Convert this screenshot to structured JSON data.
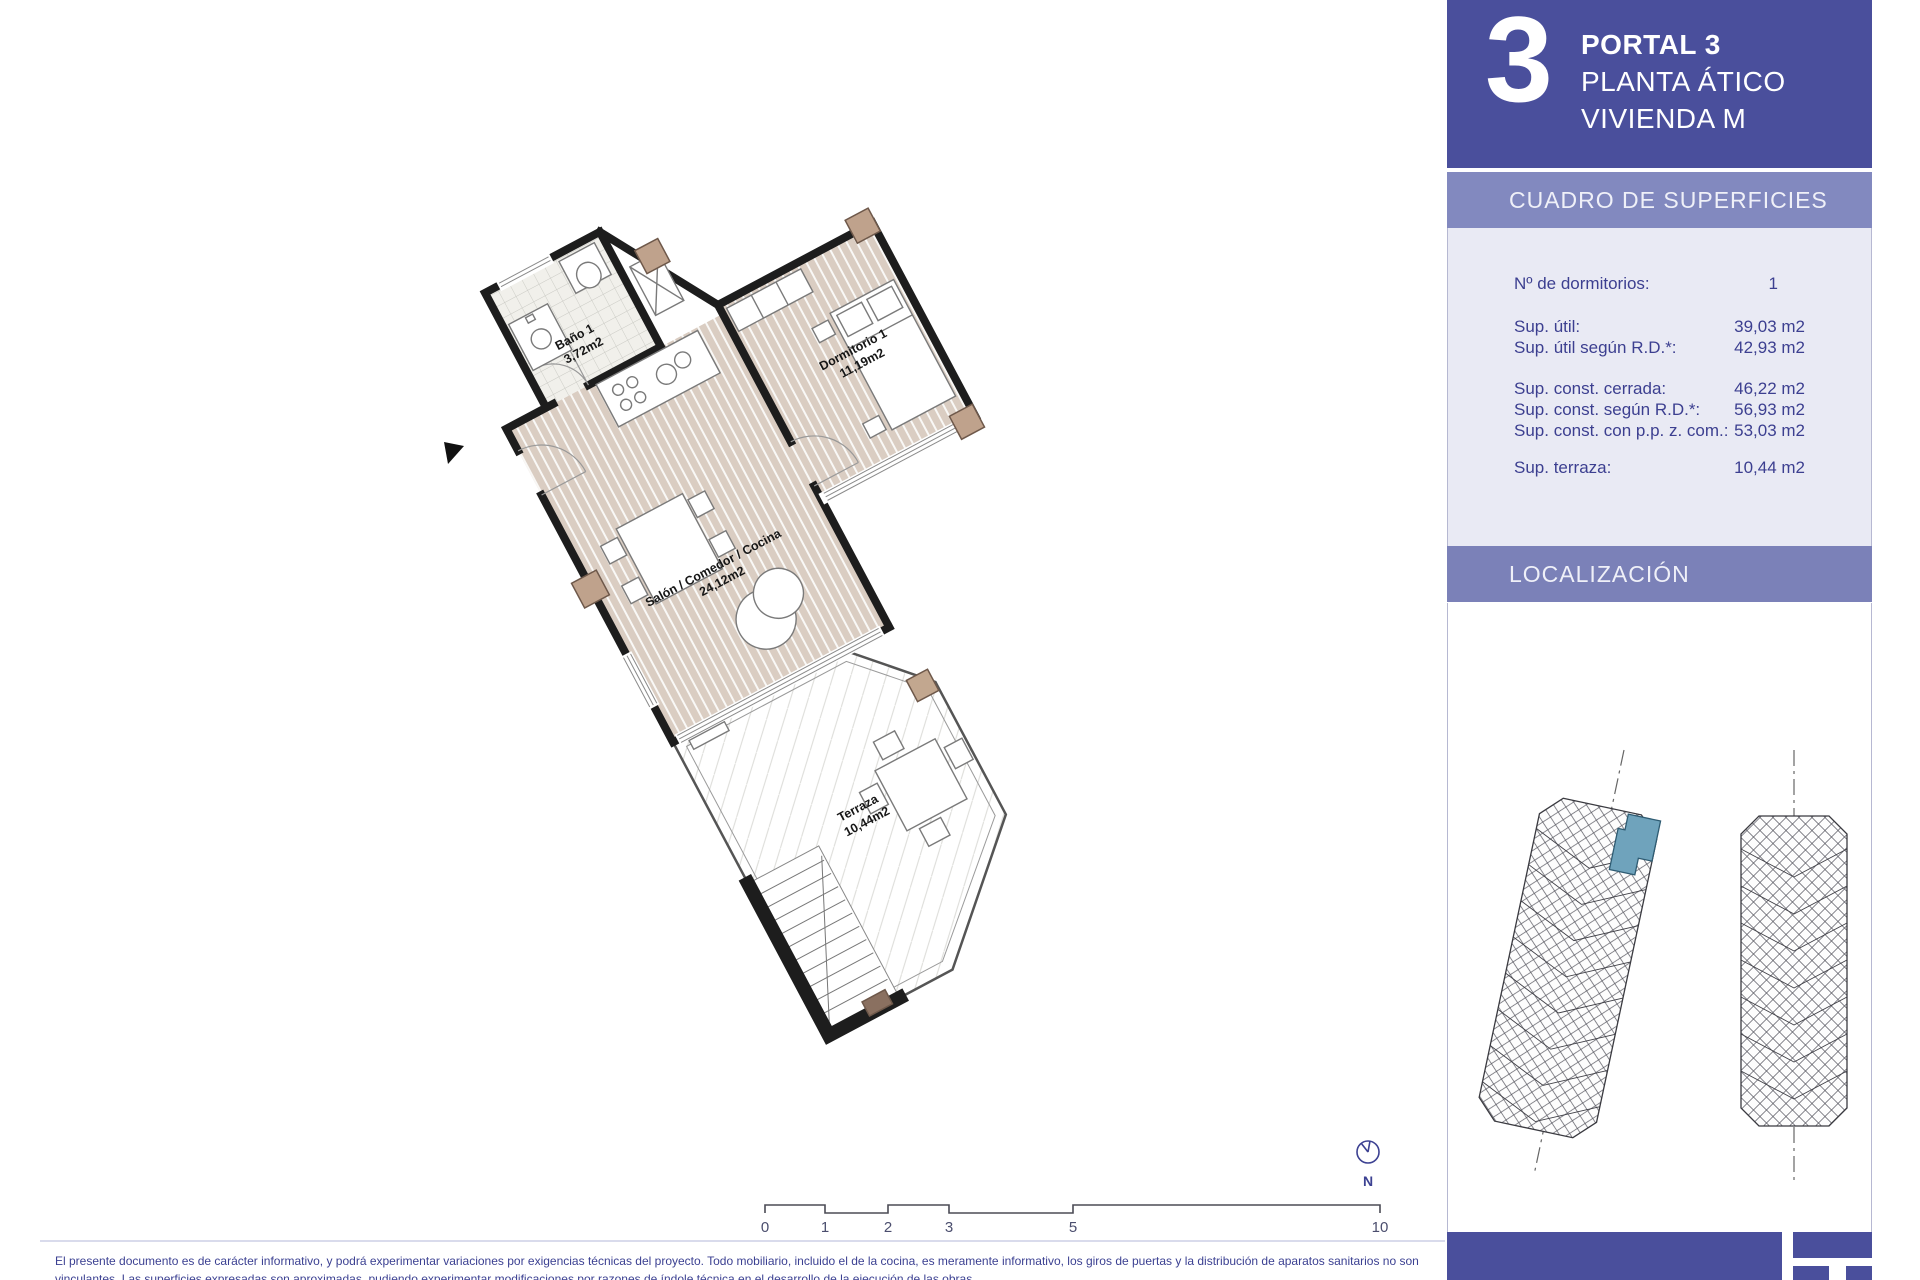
{
  "header": {
    "big_number": "3",
    "line1": "PORTAL 3",
    "line2": "PLANTA ÁTICO",
    "line3": "VIVIENDA M"
  },
  "surfaces": {
    "title": "CUADRO DE SUPERFICIES",
    "rows": [
      {
        "label": "Nº de dormitorios:",
        "value": "1"
      },
      {
        "label": "Sup. útil:",
        "value": "39,03 m2"
      },
      {
        "label": "Sup. útil según R.D.*:",
        "value": "42,93 m2"
      },
      {
        "label": "Sup. const. cerrada:",
        "value": "46,22 m2"
      },
      {
        "label": "Sup. const. según R.D.*:",
        "value": "56,93 m2"
      },
      {
        "label": "Sup. const. con p.p. z. com.:",
        "value": "53,03 m2"
      },
      {
        "label": "Sup. terraza:",
        "value": "10,44 m2"
      }
    ]
  },
  "localization": {
    "title": "LOCALIZACIÓN"
  },
  "plan": {
    "rooms": [
      {
        "name": "Baño 1",
        "area": "3,72m2"
      },
      {
        "name": "Dormitorio 1",
        "area": "11,19m2"
      },
      {
        "name": "Salón / Comedor / Cocina",
        "area": "24,12m2"
      },
      {
        "name": "Terraza",
        "area": "10,44m2"
      }
    ],
    "compass_label": "N"
  },
  "scalebar": {
    "labels": [
      "0",
      "1",
      "2",
      "3",
      "5",
      "10"
    ]
  },
  "footer": {
    "disclaimer_line1": "El presente documento es de carácter informativo, y podrá experimentar variaciones por exigencias técnicas del proyecto. Todo mobiliario, incluido el de la cocina, es meramente informativo, los giros de puertas y la distribución de aparatos sanitarios no son",
    "disclaimer_line2": "vinculantes. Las superficies expresadas son aproximadas, pudiendo experimentar modificaciones por razones de índole técnica en el desarrollo de la ejecución de las obras."
  },
  "colors": {
    "header_blue": "#4A4F9C",
    "band_blue": "#8289BF",
    "band_blue2": "#7B81B8",
    "panel_bg": "#E9EAF4",
    "navy_text": "#3C3F90",
    "highlight_unit": "#6FA3BC",
    "floor_beige": "#DACDC2",
    "pillar_brown": "#BFA28C",
    "wall_black": "#1D1D1D"
  }
}
